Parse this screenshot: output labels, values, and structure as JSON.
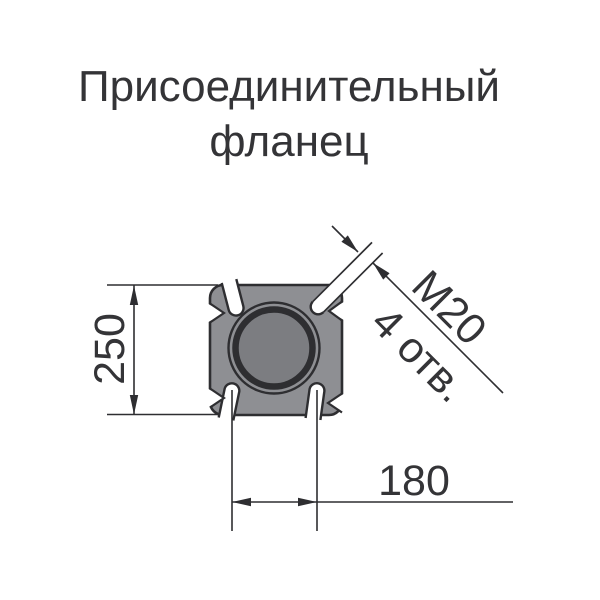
{
  "title": {
    "line1": "Присоединительный",
    "line2": "фланец"
  },
  "drawing": {
    "type": "technical-flange-front-view",
    "dimensions": {
      "flange_size_label": "250",
      "bolt_spacing_label": "180",
      "thread_label": "М20",
      "holes_count_label": "4 отв."
    },
    "features": {
      "bolt_slots": 4,
      "central_bore": 1
    }
  },
  "colors": {
    "paper": "#ffffff",
    "ink": "#343437",
    "line": "#2e2e31",
    "body": "#8e8f93",
    "bore": "#7c7d81"
  }
}
